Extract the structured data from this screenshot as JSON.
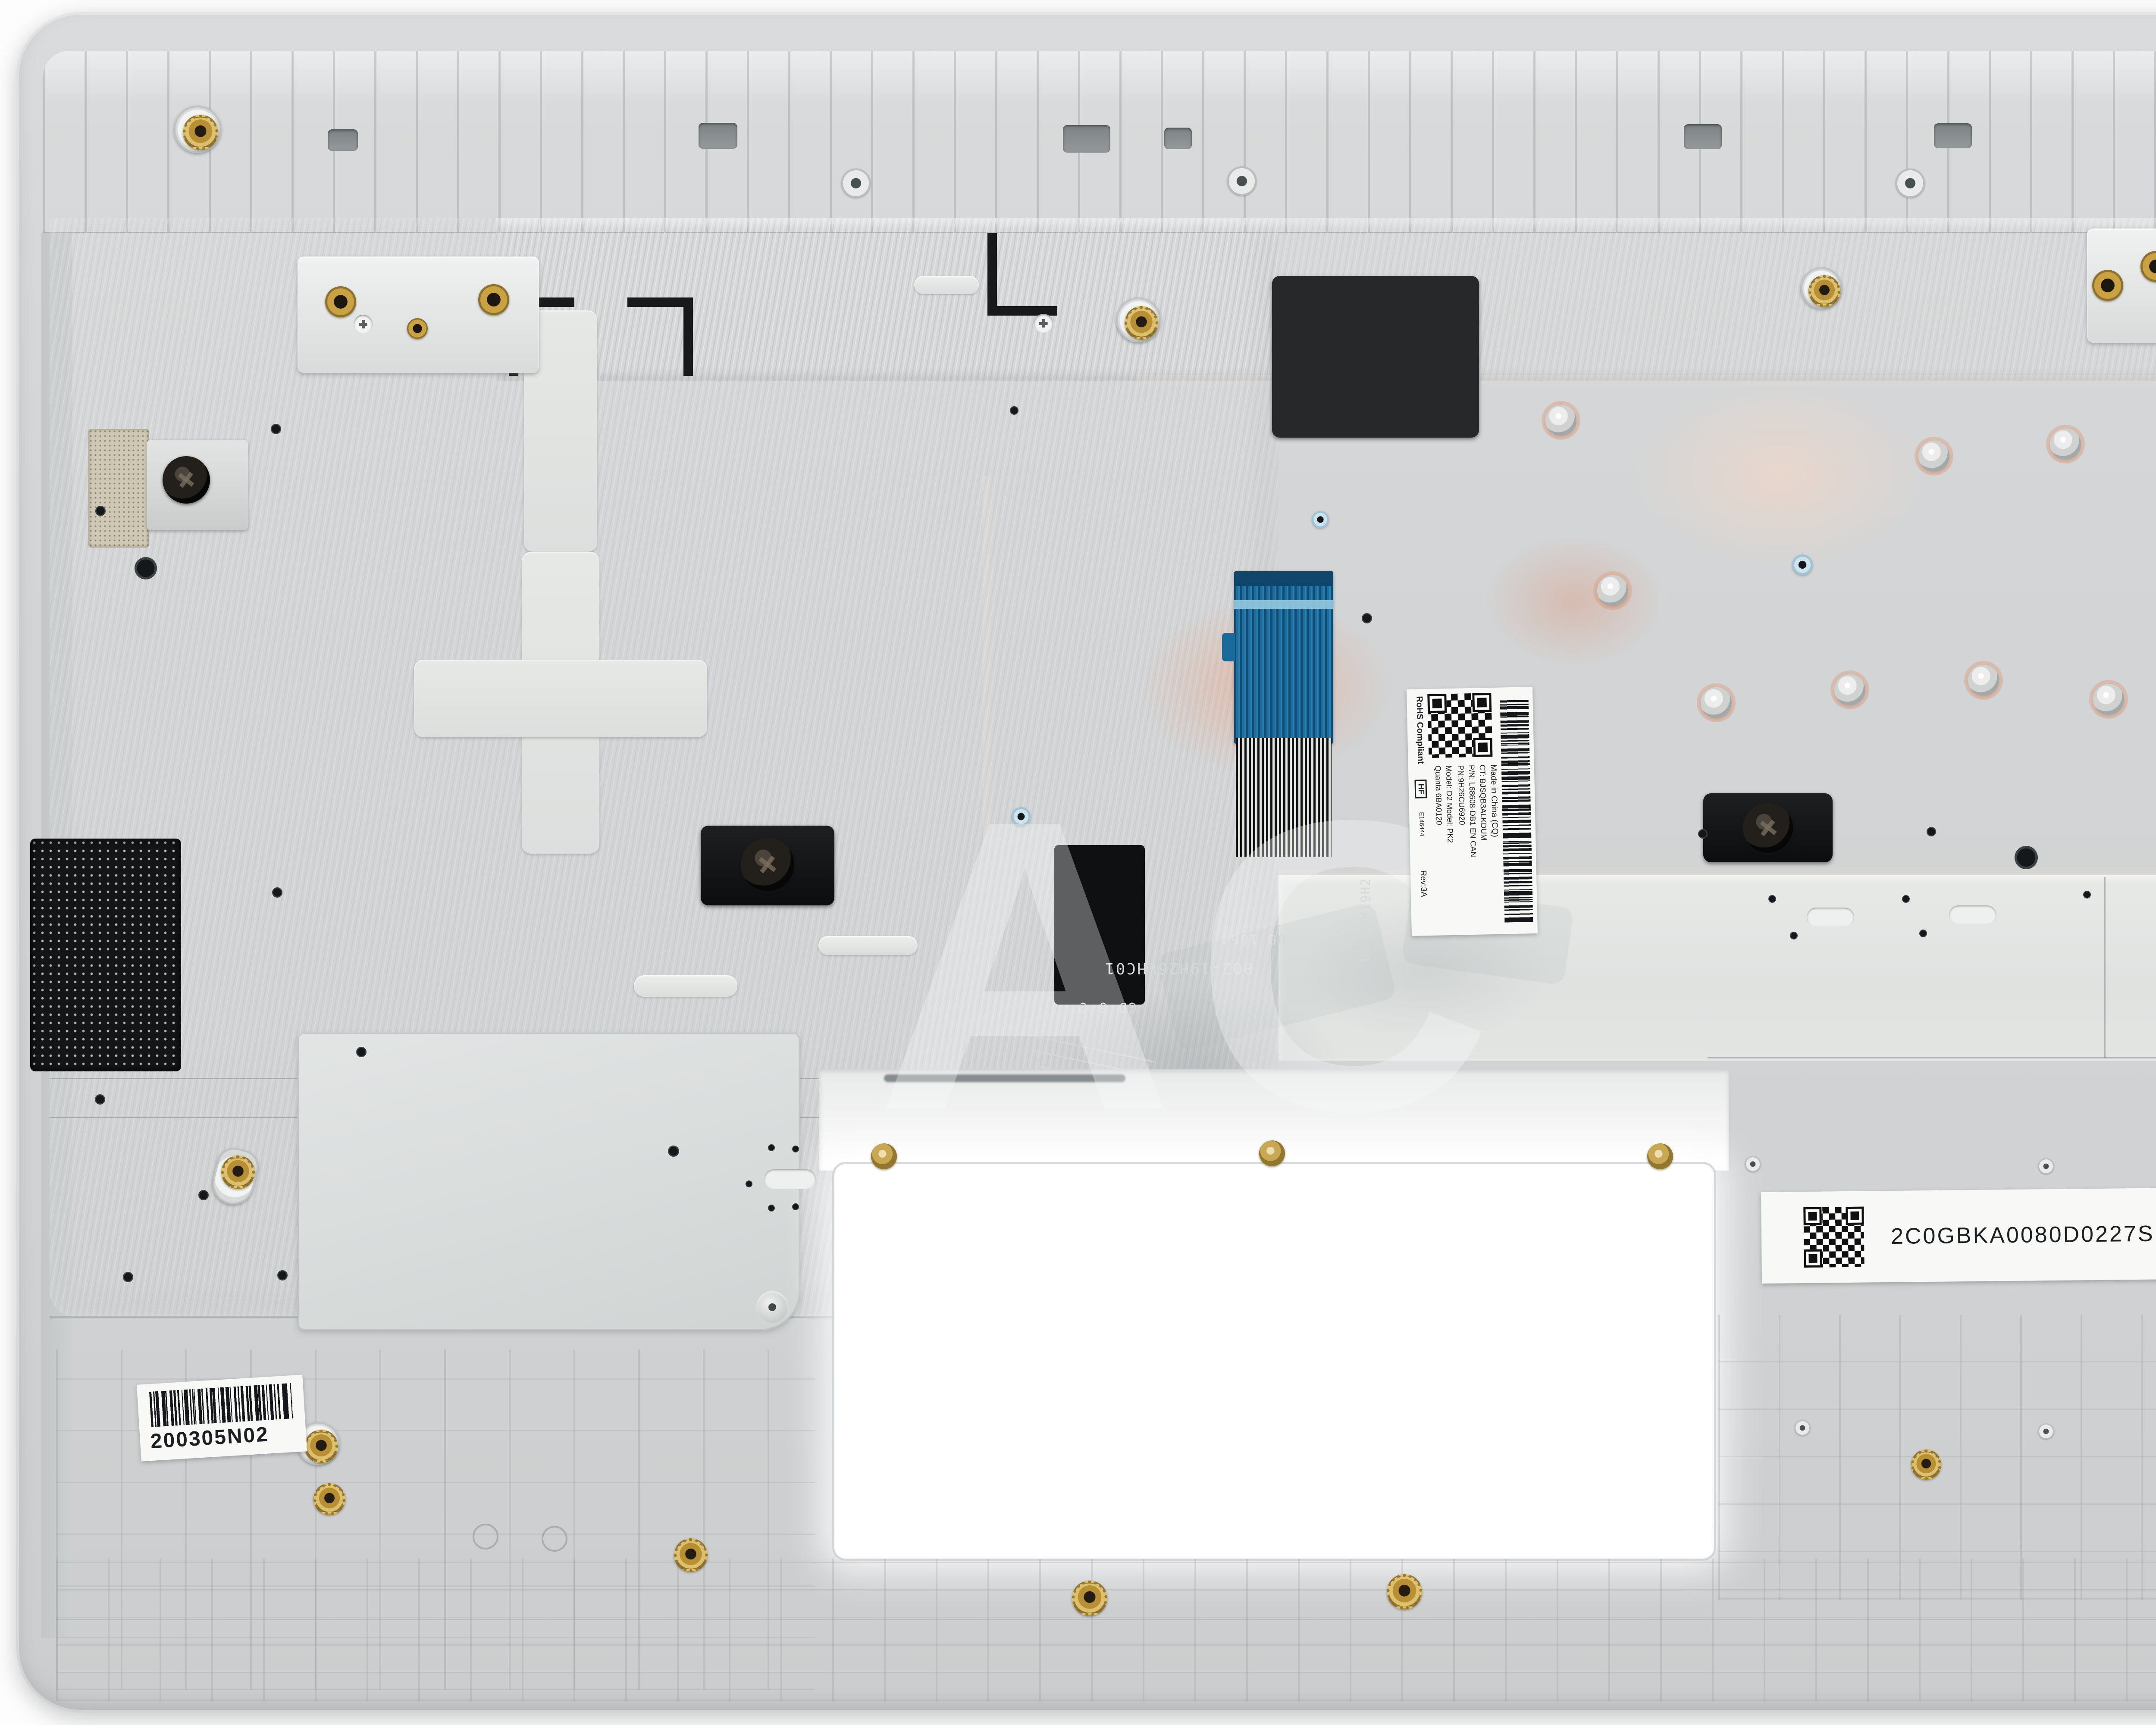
{
  "photo_subject": "laptop palmrest top-case assembly, inside view",
  "watermark": "AC",
  "labels": {
    "bottom_left": {
      "code": "200305N02"
    },
    "board": {
      "code": "2C0GBKA0080D0227SH9"
    },
    "jte": {
      "line1": "JTE: EA0GB005010-1 #1",
      "line2": "REV:3A  20.02.20 D B"
    },
    "rev": {
      "rev": "REV:3A",
      "grade": "D",
      "date": "20200407",
      "serial": "JTEEA0GB005010103AiD1521200JF"
    },
    "keyboard": {
      "made_in": "Made in China (CQ)",
      "ct": "CT: BJSQB3ALKDUM",
      "pn": "P/N: L68608-DB1  EN CAN",
      "pn2": "PN:9H26CU6920",
      "models": "Model: D2   Model: PK2",
      "vendor": "Quanta 6BA0120",
      "rohs": "RoHS Compliant",
      "hf": "HF",
      "ul": "E146444",
      "rev": "Rev:3A"
    },
    "flex": {
      "part": "002-19H26LHC01",
      "grade": "GD 6 C",
      "lot": "00 1064",
      "side": "UK HPM19H2"
    }
  },
  "colors": {
    "chassis": "#d4d6d7",
    "metal": "#d9dbd9",
    "copper": "#efb89e",
    "cable_blue": "#1b6a9c",
    "flex_black": "#1c1f21",
    "brass": "#c8a44c",
    "label_white": "#f8f8f6"
  }
}
